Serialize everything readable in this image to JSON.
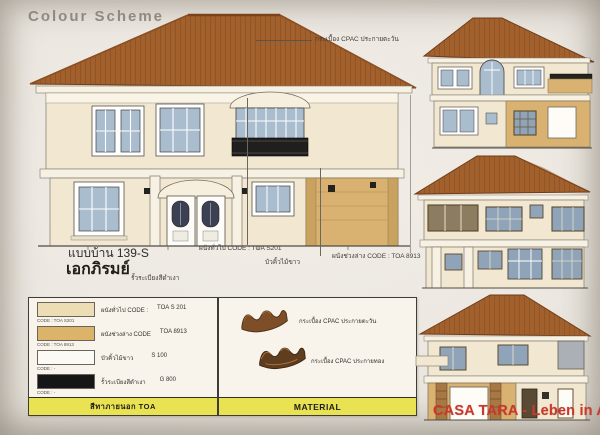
{
  "title": "Colour Scheme",
  "model": {
    "code": "แบบบ้าน 139-S",
    "name": "เอกภิรมย์"
  },
  "annotations": {
    "roof_tile": "กระเบื้อง CPAC ประกายตะวัน",
    "wall_general": "ผนังทั่วไป CODE : TOA S201",
    "molding_white": "บัวคิ้วไม้ขาว",
    "wall_lower": "ผนังช่วงล่าง CODE : TOA 8913",
    "railing_black": "รั้วระเบียงสีดำเงา"
  },
  "legend": {
    "rows": [
      {
        "label": "ผนังทั่วไป CODE :",
        "value": "TOA S 201",
        "code_small": "CODE : TOA S201",
        "swatch_style": "background:#ecddb4"
      },
      {
        "label": "ผนังช่วงล่าง CODE",
        "value": "TOA 8913",
        "code_small": "CODE : TOA 8913",
        "swatch_style": "background:#dcb469"
      },
      {
        "label": "บัวคิ้วไม้ขาว",
        "value": "S 100",
        "code_small": "CODE : -",
        "swatch_style": "background:#fbfaf5"
      },
      {
        "label": "รั้วระเบียงสีดำเงา",
        "value": "G 800",
        "code_small": "CODE : -",
        "swatch_style": "background:#161616"
      }
    ],
    "footer": "สีทาภายนอก TOA"
  },
  "material": {
    "items": [
      {
        "label": "กระเบื้อง CPAC ประกายตะวัน"
      },
      {
        "label": "กระเบื้อง CPAC ประกายทอง"
      }
    ],
    "footer": "MATERIAL"
  },
  "watermark": "CASA TARA - Leben in Asien",
  "colors": {
    "roof": "#a2602c",
    "wall": "#f2e8d1",
    "wall_lower": "#d9b170",
    "glass": "#a9bdcf",
    "railing": "#1d1d1d",
    "accent_bar": "#e9e253",
    "watermark_red": "#c7392c"
  }
}
